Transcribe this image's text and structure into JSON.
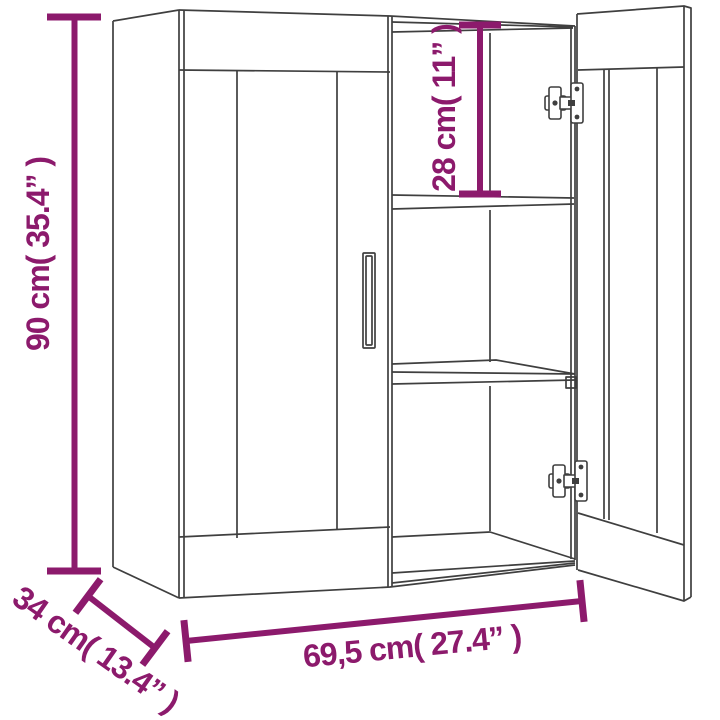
{
  "image": {
    "type": "product-dimension-diagram",
    "subject": "wall cabinet line drawing with open right door and shelves"
  },
  "colors": {
    "dimension_annotation": "#8c1a6c",
    "drawing_line": "#3f3f3f",
    "background": "#ffffff"
  },
  "dimensions": {
    "height_label": "90 cm( 35.4” )",
    "top_compartment_label": "28 cm( 11” )",
    "depth_label": "34 cm( 13.4” )",
    "width_label": "69,5 cm( 27.4” )"
  }
}
